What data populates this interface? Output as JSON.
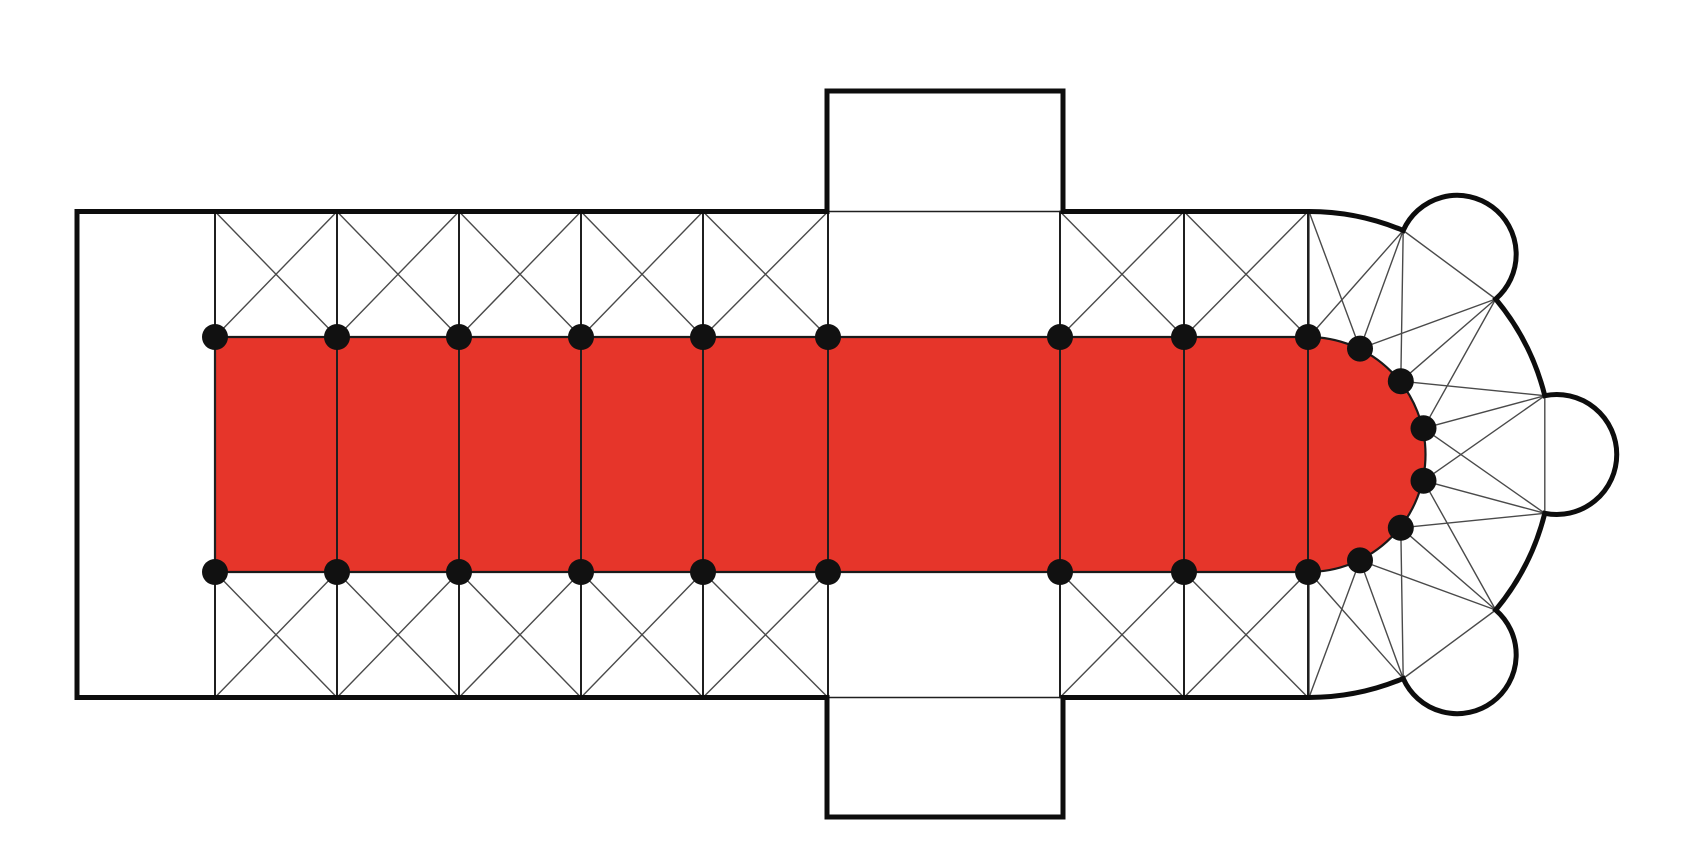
{
  "diagram": {
    "type": "romanesque-church-floor-plan",
    "description": "Cruciform basilica plan: highlighted nave-and-choir vessel, side aisles with cross (X) vault bays, projecting transept arms, semicircular apse with ambulatory and three radiating chapels, pier positions marked with dots",
    "canvas": {
      "width": 1701,
      "height": 862,
      "background": "#ffffff"
    },
    "colors": {
      "highlight_fill": "#e6352a",
      "highlight_edge": "#1a1a1a",
      "wall": "#0d0d0d",
      "rib": "#4a4a4a",
      "pier_line": "#1f1f1f",
      "dot": "#111111"
    },
    "strokes": {
      "wall_width": 5,
      "opening_width": 1.6,
      "rib_width": 1.4,
      "pier_line_width": 2,
      "highlight_edge_width": 2.2
    },
    "plan": {
      "facade_x": 77,
      "wall_top_y": 211.5,
      "wall_bottom_y": 697.5,
      "nave_top_y": 337,
      "nave_bottom_y": 572,
      "pier_xs": [
        215,
        337,
        459,
        581,
        703,
        828,
        1060,
        1184,
        1308
      ],
      "aisle_bays": [
        [
          215,
          337
        ],
        [
          337,
          459
        ],
        [
          459,
          581
        ],
        [
          581,
          703
        ],
        [
          703,
          828
        ],
        [
          1060,
          1184
        ],
        [
          1184,
          1308
        ]
      ],
      "transept": {
        "x1": 827,
        "x2": 1063,
        "top_y": 91,
        "bottom_y": 817
      },
      "apse": {
        "cx": 1309,
        "cy": 454.5,
        "inner_r": 117.5,
        "outer_r": 243,
        "inner_angles_deg": [
          90,
          64.3,
          38.6,
          12.9,
          -12.9,
          -38.6,
          -64.3,
          -90
        ],
        "outer_angles_deg": [
          90,
          67.2,
          39.8,
          14,
          -14,
          -39.8,
          -67.2,
          -90
        ],
        "chapels": [
          {
            "from_outer_index": 1,
            "to_outer_index": 2,
            "radius": 59
          },
          {
            "from_outer_index": 3,
            "to_outer_index": 4,
            "radius": 60
          },
          {
            "from_outer_index": 5,
            "to_outer_index": 6,
            "radius": 59
          }
        ]
      },
      "dot_radius": 13,
      "dot_count": 24
    }
  }
}
